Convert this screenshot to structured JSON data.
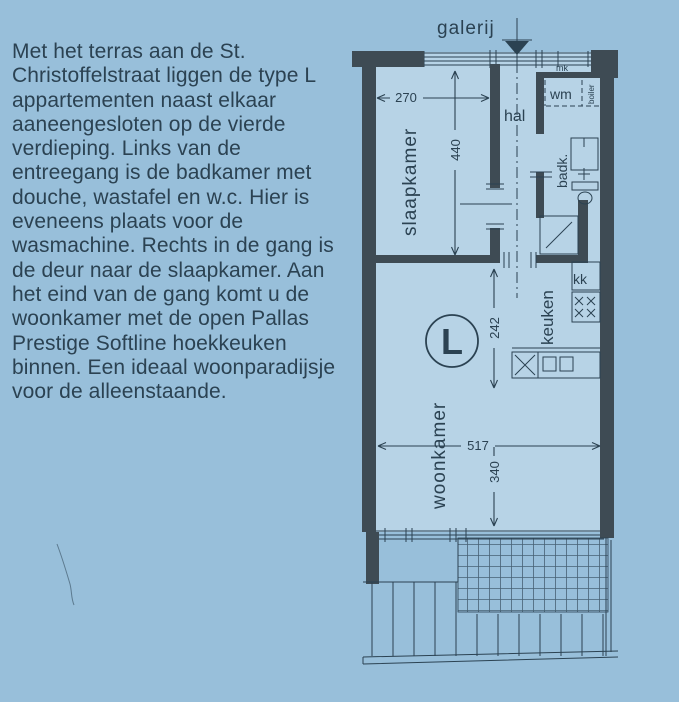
{
  "page": {
    "background_color": "#98bfda",
    "interior_color": "#b7d3e6",
    "wall_color": "#3e4b54",
    "ink_color": "#2b4252"
  },
  "description": {
    "lines": [
      "Met het terras aan de St.",
      "Christoffelstraat liggen de type L",
      "appartementen naast elkaar",
      "aaneengesloten op de vierde",
      "verdieping. Links van de",
      "entreegang is de badkamer met",
      "douche, wastafel en w.c. Hier is",
      "eveneens plaats voor de",
      "wasmachine. Rechts in de gang is",
      "de deur naar de slaapkamer. Aan",
      "het eind van de gang komt u de",
      "woonkamer met de open Pallas",
      "Prestige Softline hoekkeuken",
      "binnen. Een ideaal woonparadijsje",
      "voor de alleenstaande."
    ]
  },
  "floorplan": {
    "unit_type": "L",
    "labels": {
      "galerij": "galerij",
      "hal": "hal",
      "slaapkamer": "slaapkamer",
      "badkamer": "badk.",
      "keuken": "keuken",
      "woonkamer": "woonkamer",
      "meterkast": "mk",
      "wasmachine": "wm",
      "boiler": "boiler",
      "koelkast": "kk"
    },
    "dimensions_cm": {
      "slaapkamer_breedte": "270",
      "slaapkamer_lengte": "440",
      "keuken_lengte": "242",
      "woonkamer_breedte": "517",
      "woonkamer_lengte": "340"
    }
  }
}
